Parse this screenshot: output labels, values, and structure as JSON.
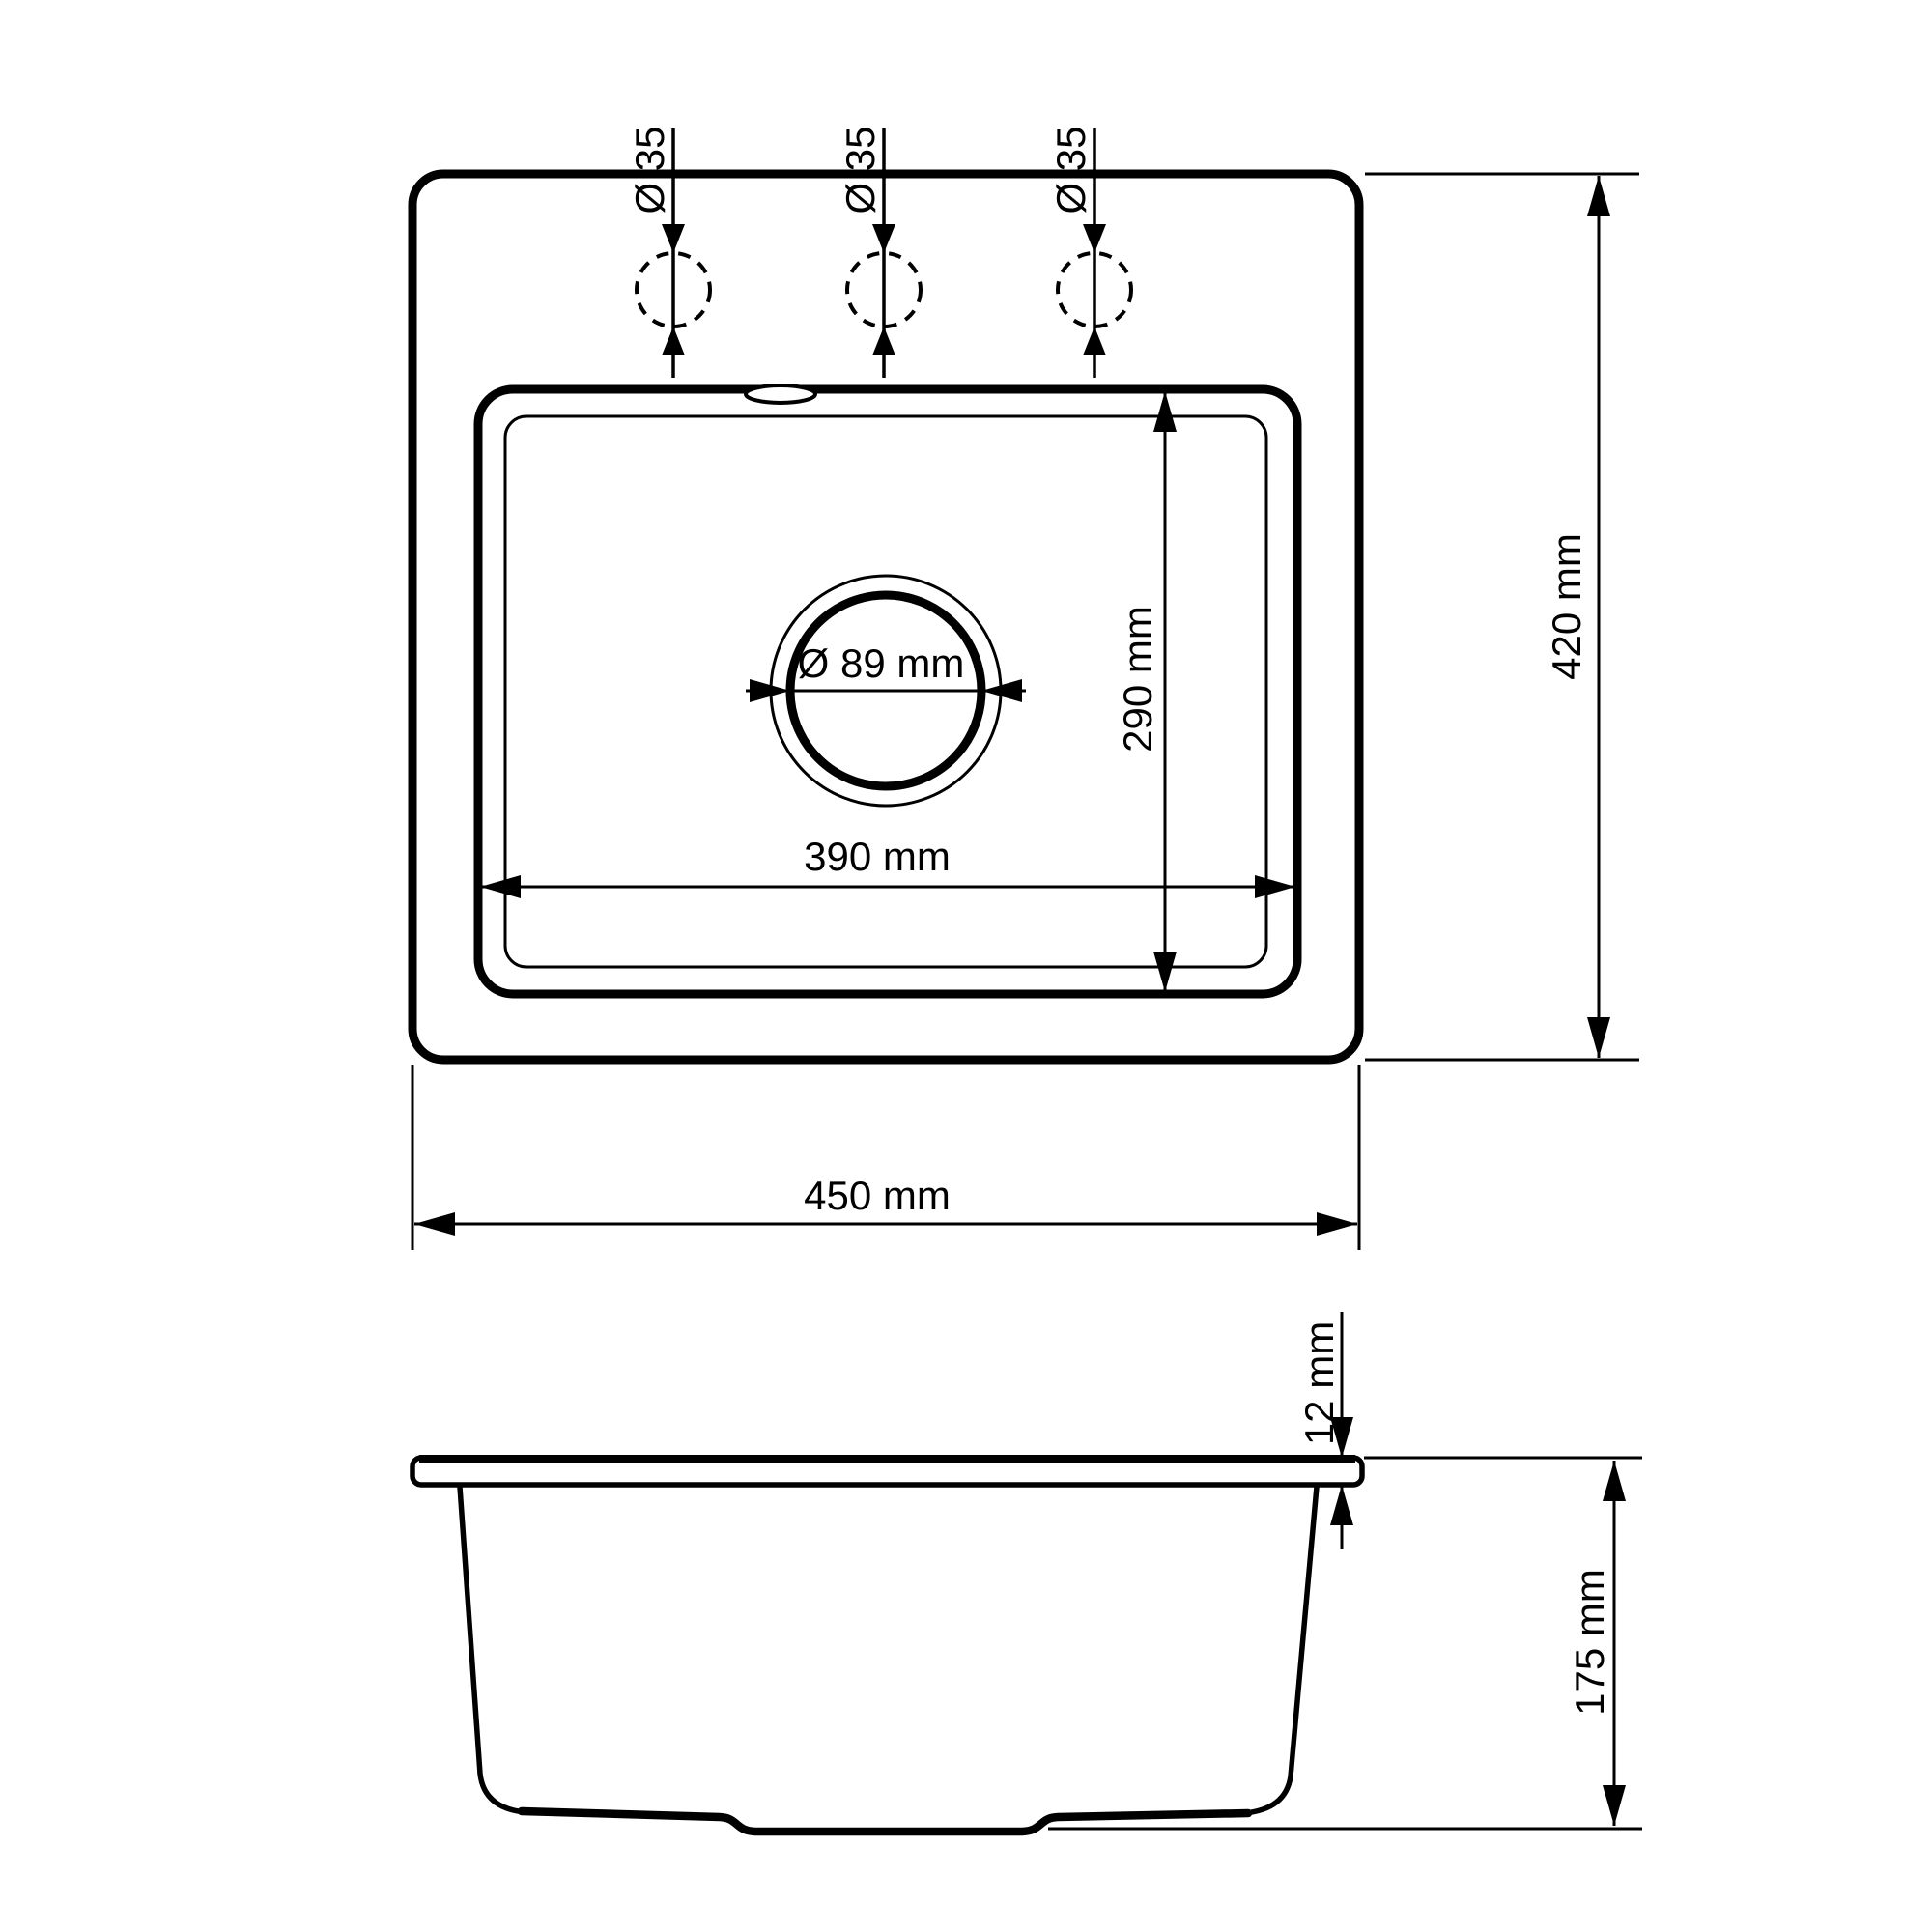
{
  "drawing": {
    "colors": {
      "line": "#000000",
      "background": "#ffffff"
    },
    "top_view": {
      "faucet_holes": [
        {
          "label": "Ø 35"
        },
        {
          "label": "Ø 35"
        },
        {
          "label": "Ø 35"
        }
      ],
      "drain": {
        "diameter_label": "Ø 89 mm"
      },
      "basin_width_label": "390 mm",
      "basin_depth_label": "290 mm",
      "overall_width_label": "450 mm",
      "overall_depth_label": "420 mm"
    },
    "side_view": {
      "rim_thickness_label": "12 mm",
      "bowl_depth_label": "175 mm"
    }
  }
}
